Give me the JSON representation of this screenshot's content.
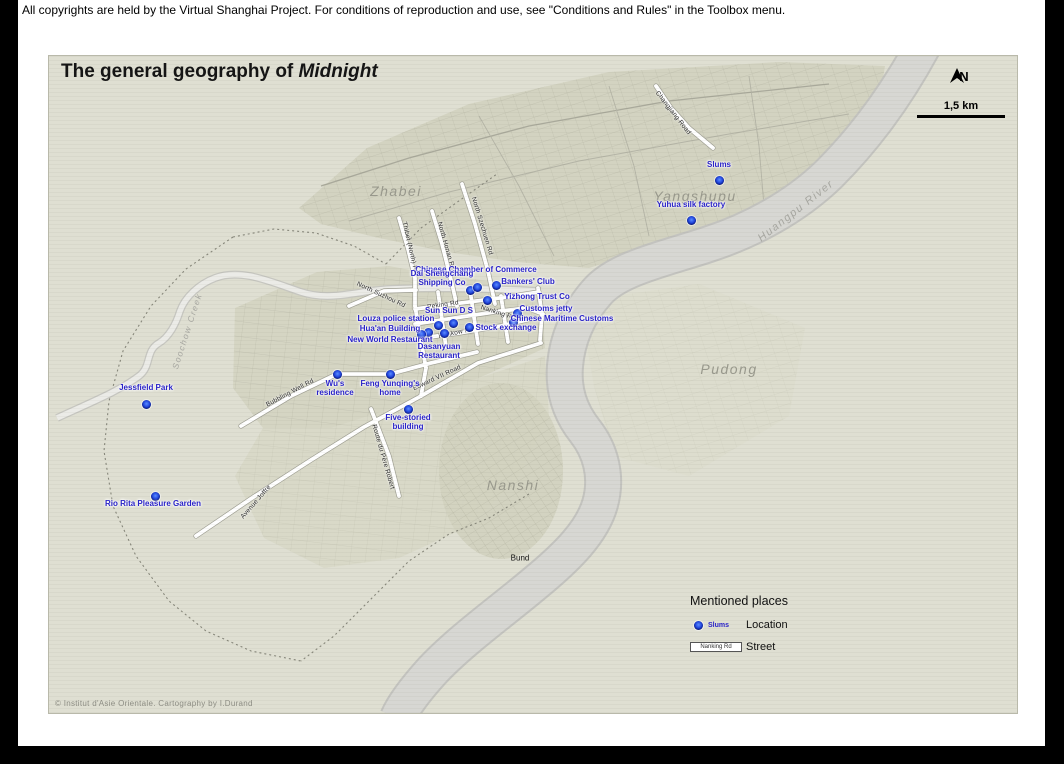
{
  "copyright_bar": {
    "text": "All copyrights are held by the Virtual Shanghai Project. For conditions of reproduction and use, see \"Conditions and Rules\" in the Toolbox menu."
  },
  "map": {
    "title": {
      "prefix": "The general geography of ",
      "emphasis": "Midnight"
    },
    "north_label": "N",
    "scale_label": "1,5 km",
    "credit": "© Institut d'Asie Orientale. Cartography by I.Durand",
    "bund_label": "Bund",
    "districts": [
      {
        "name": "Zhabei"
      },
      {
        "name": "Yangshupu"
      },
      {
        "name": "Pudong"
      },
      {
        "name": "Nanshi"
      }
    ],
    "water": [
      {
        "name": "Huangpu River"
      },
      {
        "name": "Soochow Creek"
      }
    ],
    "roads": [
      {
        "name": "Changjiang Road"
      },
      {
        "name": "North Szechuen Rd"
      },
      {
        "name": "North Honan Rd"
      },
      {
        "name": "Thibet (North) Rd"
      },
      {
        "name": "North Suzhou Rd"
      },
      {
        "name": "Peking Rd"
      },
      {
        "name": "Nanking Rd"
      },
      {
        "name": "Hankow Rd"
      },
      {
        "name": "Bubbling Well Rd"
      },
      {
        "name": "Edward VII Road"
      },
      {
        "name": "Avenue Joffre"
      },
      {
        "name": "Route du Père Robert"
      }
    ],
    "locations": [
      {
        "label": "Slums"
      },
      {
        "label": "Yuhua silk factory"
      },
      {
        "label": "Chinese Chamber of Commerce"
      },
      {
        "label": "Dai Shengchang\nShipping Co"
      },
      {
        "label": "Bankers' Club"
      },
      {
        "label": "Yizhong Trust Co"
      },
      {
        "label": "Customs jetty"
      },
      {
        "label": "Chinese Maritime Customs"
      },
      {
        "label": "Stock exchange"
      },
      {
        "label": "Sun Sun D S"
      },
      {
        "label": "Louza police station"
      },
      {
        "label": "Hua'an Building"
      },
      {
        "label": "New World Restaurant"
      },
      {
        "label": "Dasanyuan\nRestaurant"
      },
      {
        "label": "Wu's\nresidence"
      },
      {
        "label": "Feng Yunqing's\nhome"
      },
      {
        "label": "Five-storied\nbuilding"
      },
      {
        "label": "Jessfield Park"
      },
      {
        "label": "Rio Rita Pleasure Garden"
      }
    ],
    "legend": {
      "title": "Mentioned places",
      "location_sample": "Slums",
      "location_label": "Location",
      "street_sample": "Nanking Rd",
      "street_label": "Street"
    },
    "colors": {
      "accent_blue": "#2a23c8",
      "dot_blue": "#2146dd",
      "map_background": "#dfdfd2",
      "river_gray": "#d7d7d3",
      "road_white": "#ffffff"
    }
  }
}
